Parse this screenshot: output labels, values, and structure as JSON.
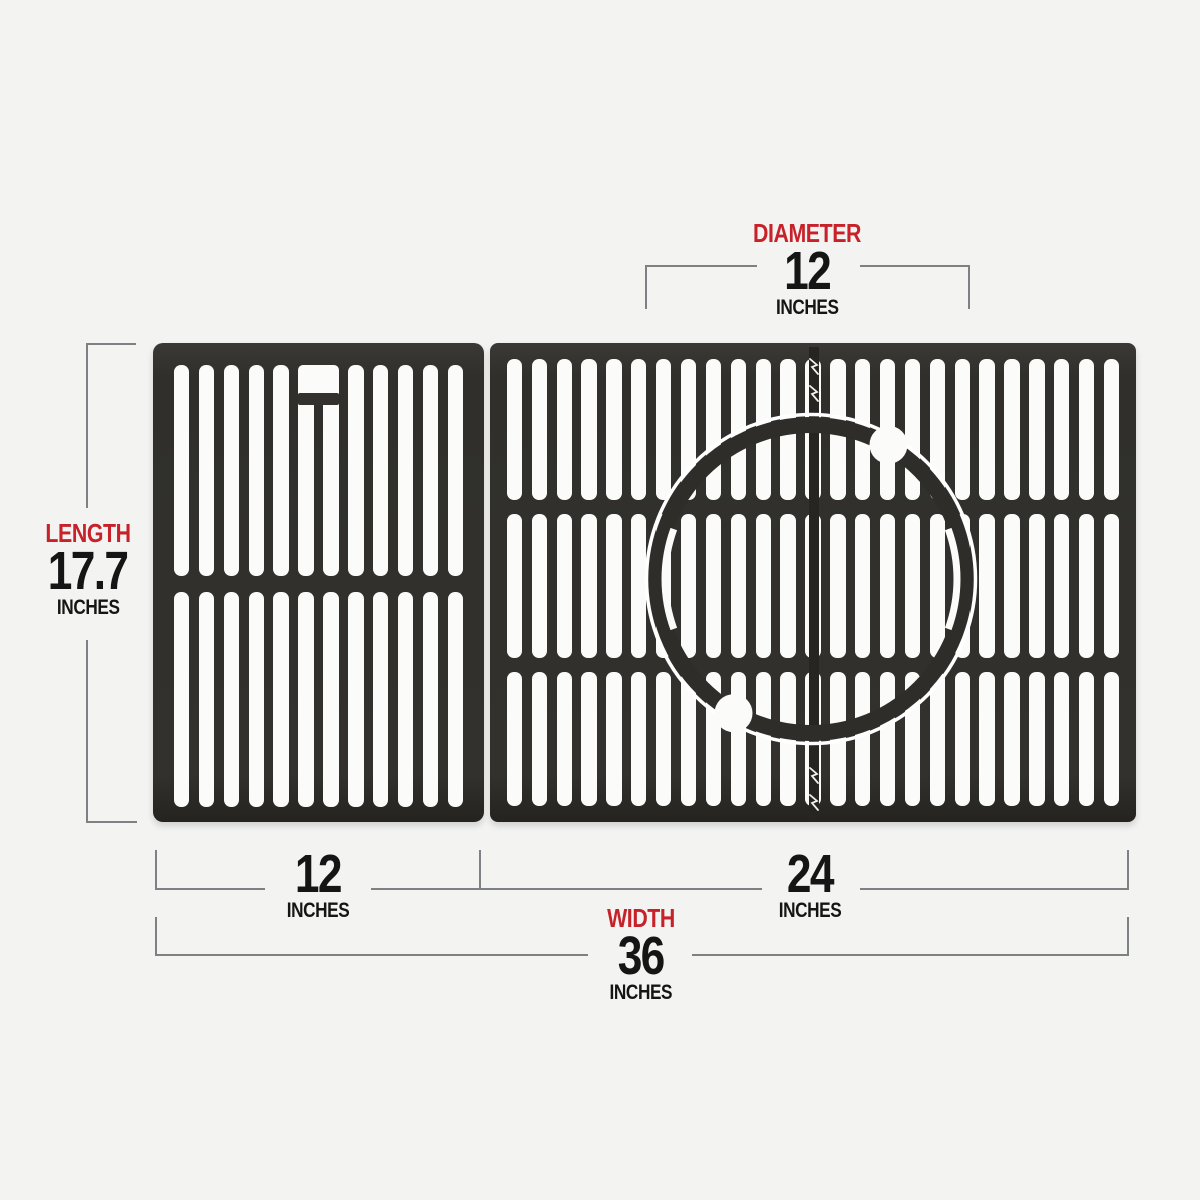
{
  "title": "Grill grate dimension diagram",
  "colors": {
    "bg": "#f3f3f1",
    "accent_red": "#c7222a",
    "ink": "#151515",
    "dim_line": "#7e8183",
    "grate_dark": "#32312d",
    "slot_white": "#fbfbf9",
    "seam_dark": "#262522",
    "ring_band": "#2e2d29",
    "ring_gap_white": "#ffffff"
  },
  "measurements": {
    "diameter": {
      "label": "DIAMETER",
      "value": "12",
      "unit": "INCHES"
    },
    "length": {
      "label": "LENGTH",
      "value": "17.7",
      "unit": "INCHES"
    },
    "left_width": {
      "value": "12",
      "unit": "INCHES"
    },
    "right_width": {
      "value": "24",
      "unit": "INCHES"
    },
    "total_width": {
      "label": "WIDTH",
      "value": "36",
      "unit": "INCHES"
    }
  }
}
